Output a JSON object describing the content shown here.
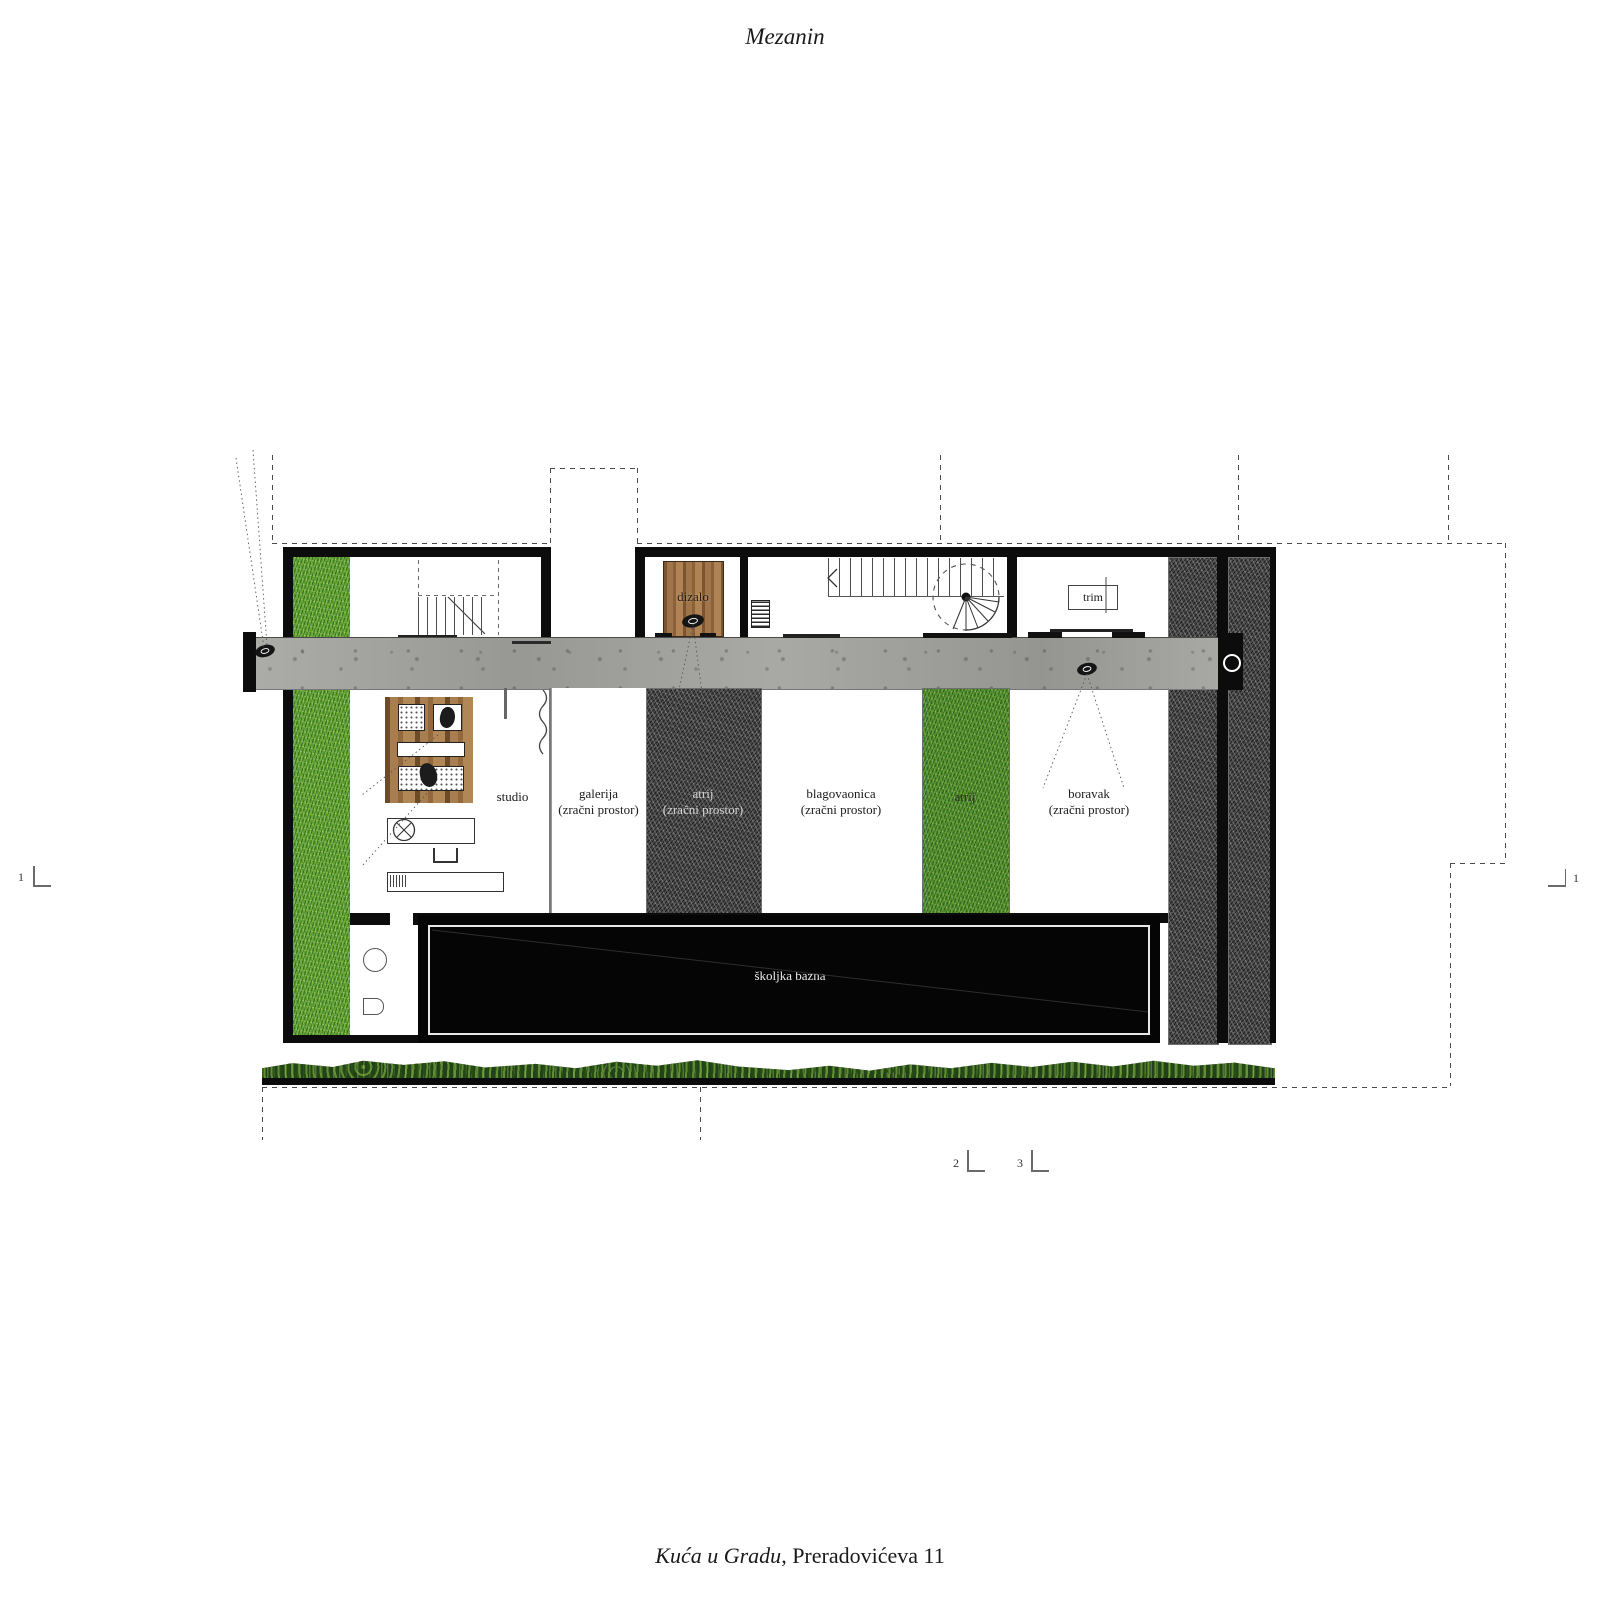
{
  "title": "Mezanin",
  "caption": {
    "project_name": "Kuća u Gradu",
    "address": ", Preradovićeva 11"
  },
  "plan": {
    "rooms": [
      {
        "id": "studio",
        "lines": [
          "studio",
          ""
        ]
      },
      {
        "id": "galerija",
        "lines": [
          "galerija",
          "(zračni prostor)"
        ]
      },
      {
        "id": "atrij-dark",
        "lines": [
          "atrij",
          "(zračni prostor)"
        ]
      },
      {
        "id": "blagovaonica",
        "lines": [
          "blagovaonica",
          "(zračni prostor)"
        ]
      },
      {
        "id": "atrij-green",
        "lines": [
          "atrij",
          ""
        ]
      },
      {
        "id": "boravak",
        "lines": [
          "boravak",
          "(zračni prostor)"
        ]
      }
    ],
    "elevator_label": "dizalo",
    "trim_label": "trim",
    "pool_label": "školjka bazna"
  },
  "section_markers": {
    "left": "1",
    "right": "1",
    "bottom_left": "2",
    "bottom_right": "3"
  },
  "colors": {
    "wall": "#0c0c0c",
    "concrete": "#a3a39f",
    "grass": "#5fa32f",
    "dark_turf": "#454545",
    "wood": "#a87e50",
    "hedge": "#24401a",
    "pool": "#050505"
  }
}
